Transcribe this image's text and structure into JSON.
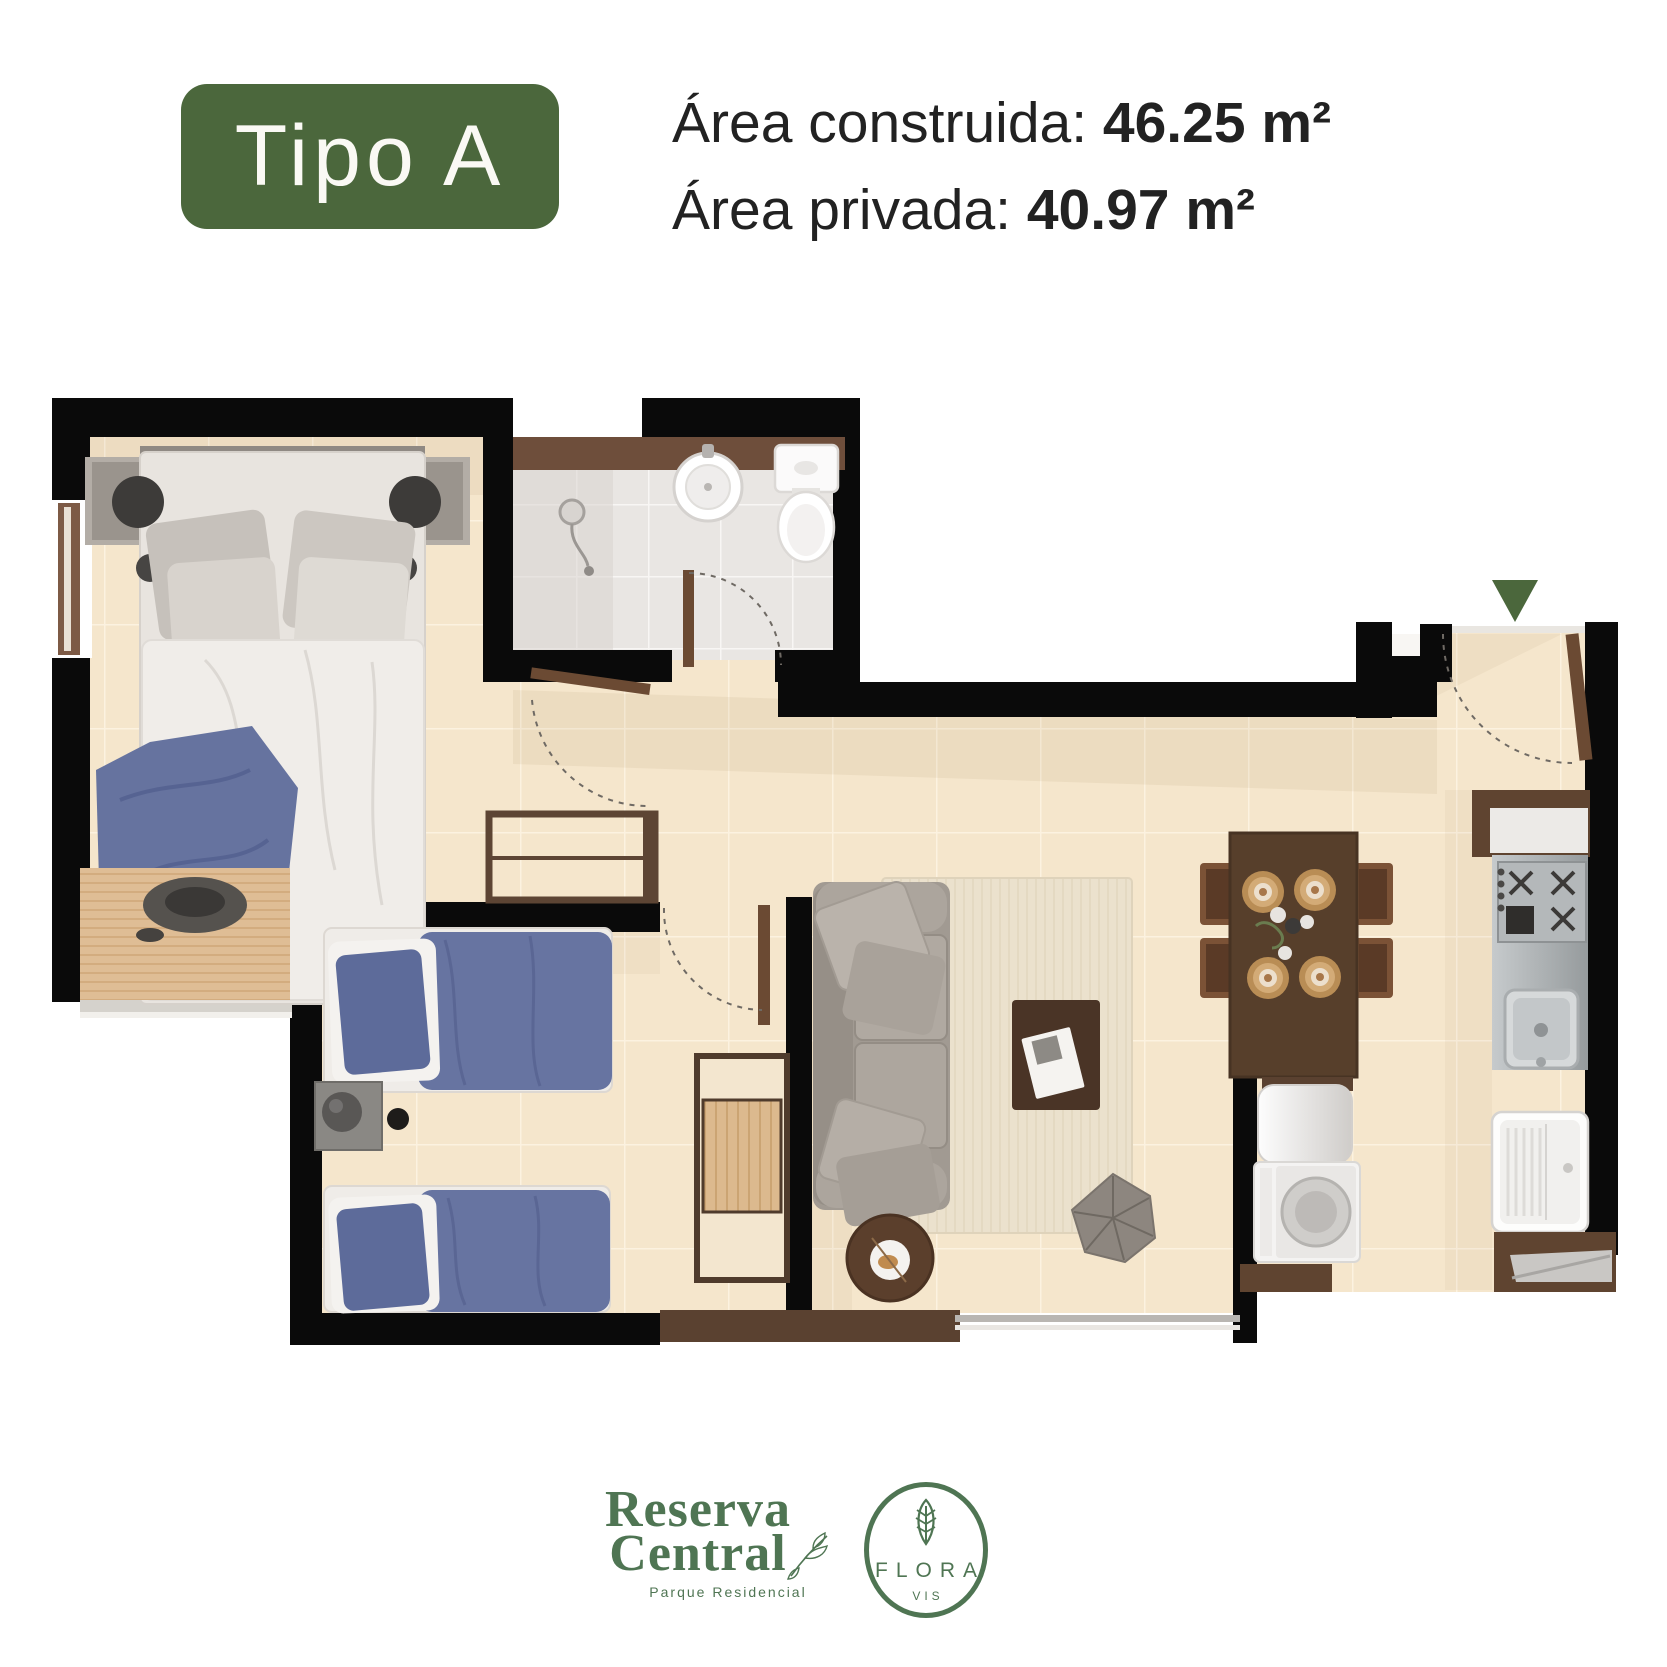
{
  "header": {
    "type_badge": "Tipo A",
    "line1_label": "Área construida: ",
    "line1_value": "46.25 m²",
    "line2_label": "Área privada: ",
    "line2_value": "40.97 m²"
  },
  "footer": {
    "primary_brand_line1": "Reserva",
    "primary_brand_line2": "Central",
    "primary_brand_subtitle": "Parque Residencial",
    "secondary_brand_name": "FLORA",
    "secondary_brand_subtitle": "VIS"
  },
  "floorplan": {
    "entrance_marker_icon": "entrance-arrow-icon",
    "rooms_depicted": [
      "master-bedroom",
      "bathroom",
      "secondary-bedroom",
      "living-room",
      "dining-area",
      "kitchen",
      "laundry-area",
      "entrance-hall"
    ]
  },
  "colors": {
    "accent_green": "#4b673c",
    "logo_green": "#4f7553",
    "wall_black": "#0a0a0a",
    "floor_beige": "#f5e6cc",
    "bath_gray": "#e9e6e3",
    "wood_brown": "#6b4a33",
    "bedding_blue": "#6673a1",
    "sofa_gray": "#a19a92",
    "text_dark": "#222222"
  }
}
